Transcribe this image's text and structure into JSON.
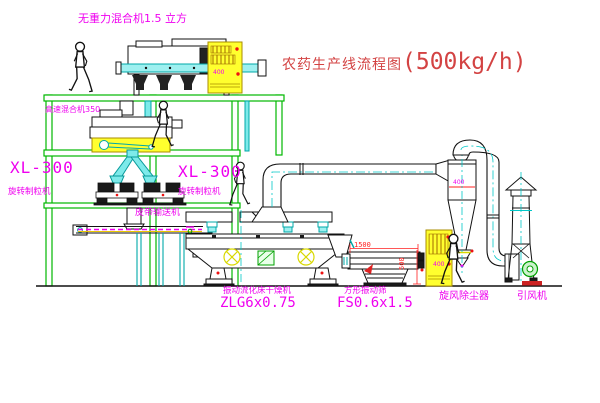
{
  "title": {
    "name": "农药生产线流程图",
    "capacity": "(500kg/h)"
  },
  "labels": {
    "top_mixer": "无重力混合机1.5 立方",
    "high_speed_mixer": "高速混合机350",
    "granulator_left": {
      "model": "XL-300",
      "name": "旋转制粒机"
    },
    "granulator_mid": {
      "model": "XL-300",
      "name": "旋转制粒机"
    },
    "belt_conveyor": "皮带输送机",
    "dryer": {
      "name": "振动流化床干燥机",
      "model": "ZLG6x0.75"
    },
    "screen": {
      "name": "方形振动筛",
      "model": "FS0.6x1.5"
    },
    "cyclone": "旋风除尘器",
    "fan": "引风机"
  },
  "dimensions": {
    "screen_length": "1500",
    "screen_height": "500"
  },
  "annotations": {
    "cabinet_top": "400",
    "cyclone_width": "400",
    "cabinet_right": "400"
  },
  "colors": {
    "structure_green": "#00b800",
    "label_magenta": "#ef00ef",
    "title_red": "#d34343",
    "dimension_red": "#ff1f1f",
    "centerline_cyan": "#00c8c8",
    "chute_cyan_fill": "#7deaea",
    "cabinet_yellow": "#ffff2e",
    "fan_green": "#00a000",
    "base_red": "#cc2222",
    "wheel_yellow": "#d8d800"
  }
}
